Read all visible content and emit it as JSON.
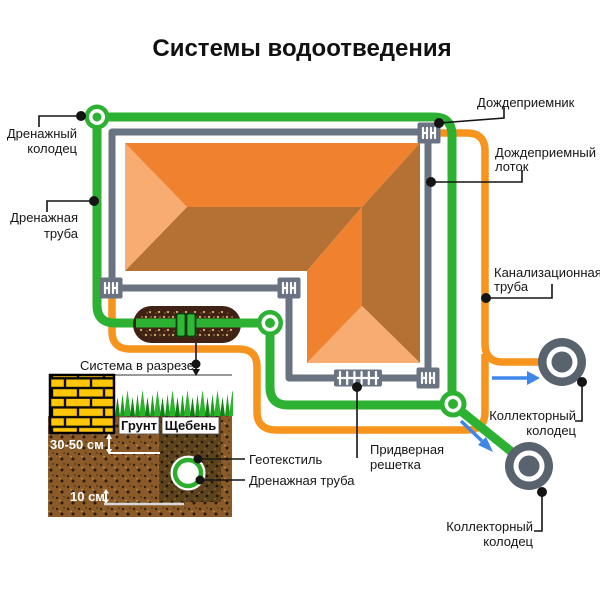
{
  "title": {
    "text": "Системы водоотведения"
  },
  "labels": {
    "drain_well": {
      "line1": "Дренажный",
      "line2": "колодец"
    },
    "drain_pipe": {
      "line1": "Дренажная",
      "line2": "труба"
    },
    "rain_inlet": {
      "line1": "Дождеприемник"
    },
    "rain_tray": {
      "line1": "Дождеприемный",
      "line2": "лоток"
    },
    "sewer_pipe": {
      "line1": "Канализационная",
      "line2": "труба"
    },
    "collector_well_1": {
      "line1": "Коллекторный",
      "line2": "колодец"
    },
    "collector_well_2": {
      "line1": "Коллекторный",
      "line2": "колодец"
    },
    "door_grate": {
      "line1": "Придверная",
      "line2": "решетка"
    },
    "section_view": {
      "line1": "Система в разрезе"
    },
    "soil": "Грунт",
    "gravel": "Щебень",
    "depth_30_50": "30-50 см",
    "depth_10": "10 см",
    "geotextile": "Геотекстиль",
    "drain_pipe_section": "Дренажная труба"
  },
  "colors": {
    "pipe_green": "#2DB133",
    "pipe_orange": "#F7941D",
    "wall_gray": "#6A7382",
    "well_gray": "#59636E",
    "arrow_blue": "#3E86E8",
    "roof_light": "#F9AC72",
    "roof_mid": "#F0822F",
    "roof_dark": "#B57033",
    "brick_yellow": "#FFC60A",
    "soil_brown": "#8A5B28",
    "trench_brown": "#5C431B",
    "grass_green": "#2CB32C"
  },
  "icons": {
    "drain_well_icon": "green-ring",
    "junction_icon": "green-ring-dot",
    "collector_well_icon": "gray-ring",
    "rain_inlet_icon": "hatch-square",
    "door_grate_icon": "hatch-grate",
    "flow_arrow_icon": "blue-arrow",
    "coupling_icon": "pipe-coupling"
  }
}
